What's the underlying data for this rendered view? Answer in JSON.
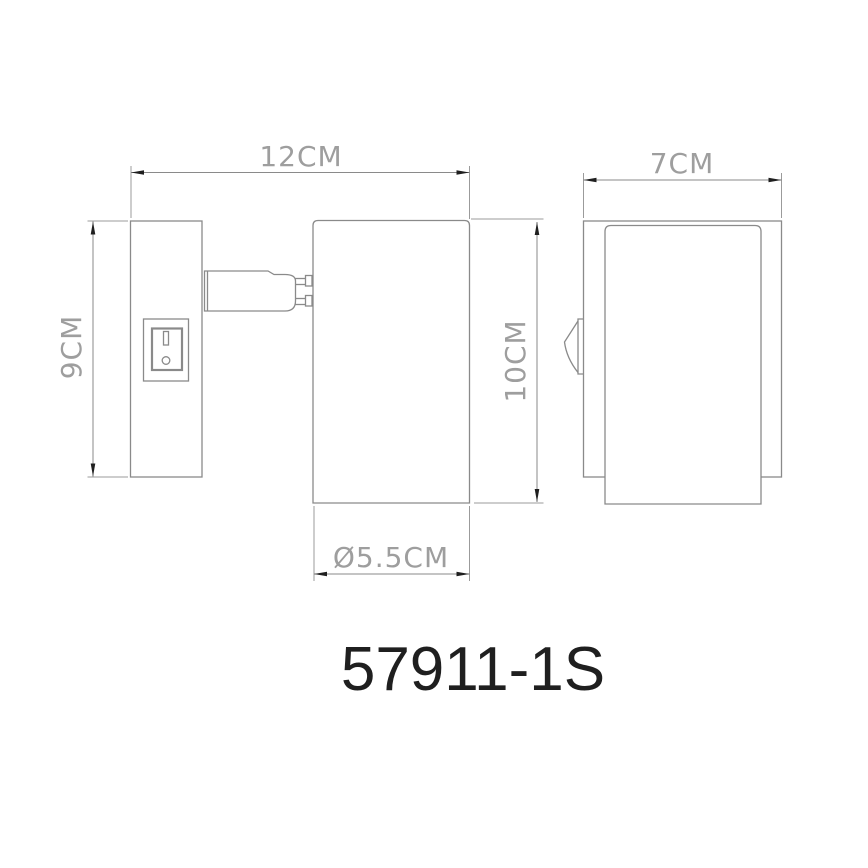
{
  "drawing": {
    "product_code": "57911-1S",
    "type_hint": "wall-spotlight dimensional drawing, front and side view",
    "colors": {
      "background": "#ffffff",
      "line": "#8a8a8a",
      "arrowhead": "#1f1f1f",
      "dimension_text": "#9e9e9e",
      "code_text": "#1f1f1f"
    },
    "dimensions": {
      "overall_width": "12CM",
      "plate_height": "9CM",
      "body_height": "10CM",
      "body_diameter": "Ø5.5CM",
      "overall_depth": "7CM"
    }
  }
}
